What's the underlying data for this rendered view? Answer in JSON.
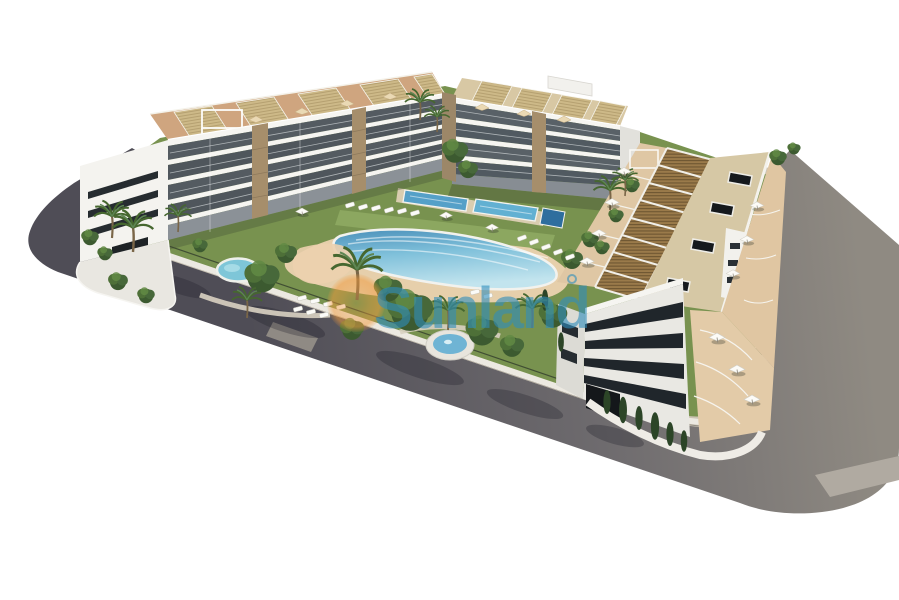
{
  "watermark": {
    "text": "Sunland",
    "text_color": "#2f8ebd",
    "text_opacity": 0.6,
    "sun_color": "#f0993c"
  },
  "scene": {
    "type": "3d-architectural-render-aerial",
    "elements": [
      "apartment-building-back-left",
      "apartment-building-back-center",
      "apartment-building-right-wing",
      "main-pool",
      "kids-pool",
      "lap-pools",
      "garden-pond",
      "perimeter-road",
      "sidewalk",
      "rooftop-pergolas",
      "palm-trees",
      "sun-loungers",
      "terrace-umbrellas"
    ],
    "colors": {
      "background": "#ffffff",
      "road_dark": "#4f4d56",
      "road_light": "#8f8a82",
      "sidewalk": "#cbc3b3",
      "lawn": "#78924f",
      "pool_deep": "#4b90ba",
      "pool_shallow": "#c2e4ee",
      "sand_deck": "#e6cfab",
      "building_white": "#f3f2ee",
      "facade_shadow": "#e7e6e1",
      "window_dark": "#20262b",
      "terrace_terracotta": "#cfa57f",
      "pergola_brown": "#9a7a4a",
      "pergola_straw": "#cdb988"
    }
  }
}
